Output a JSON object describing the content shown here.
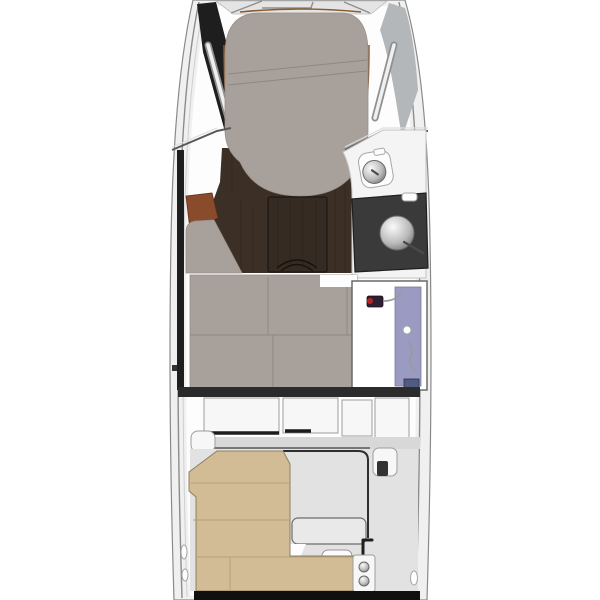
{
  "title": "motor-yacht-interior-deck-plan",
  "colors": {
    "background": "#ffffff",
    "hull_fill": "#f0f0f0",
    "hull_outline": "#8a8a8a",
    "hull_shadow_dark": "#1e1e1e",
    "deck_gray": "#b3b7b9",
    "cushion": "#a8a09b",
    "cushion_seam": "#8f8781",
    "walnut_floor": "#3c2f26",
    "table_wood": "#362b22",
    "rust_panel": "#8a4a2c",
    "counter_charcoal": "#3a3a3a",
    "shower_panel_lavender": "#9a9ac2",
    "shower_accent_red": "#bb2222",
    "cockpit_seat_tan": "#d2bc96",
    "cockpit_floor": "#e2e2e2",
    "panel_white": "#f7f7f7",
    "bulkhead_dark": "#2b2b2b",
    "transom_black": "#101010",
    "trim_brown": "#8a5a30"
  },
  "regions": {
    "hull": "boat-hull-top-view",
    "bow_deck": "bow-deck",
    "v_berth": "v-berth-double-bed",
    "salon": "portside-settee-and-dinette",
    "settee": "settee-cushion",
    "dinette_table": "dinette-table",
    "head": "head-compartment",
    "toilet": "marine-toilet",
    "vanity": "vanity-counter-with-sink",
    "mid_berth": "mid-cabin-berth",
    "shower": "shower-stall",
    "companionway": "companionway-steps",
    "cockpit": "cockpit",
    "cockpit_seats": "l-shaped-cockpit-seating",
    "stern_bench": "stern-bench",
    "wet_bar": "stern-panel-with-cupholders",
    "transom": "transom-swim-platform"
  }
}
